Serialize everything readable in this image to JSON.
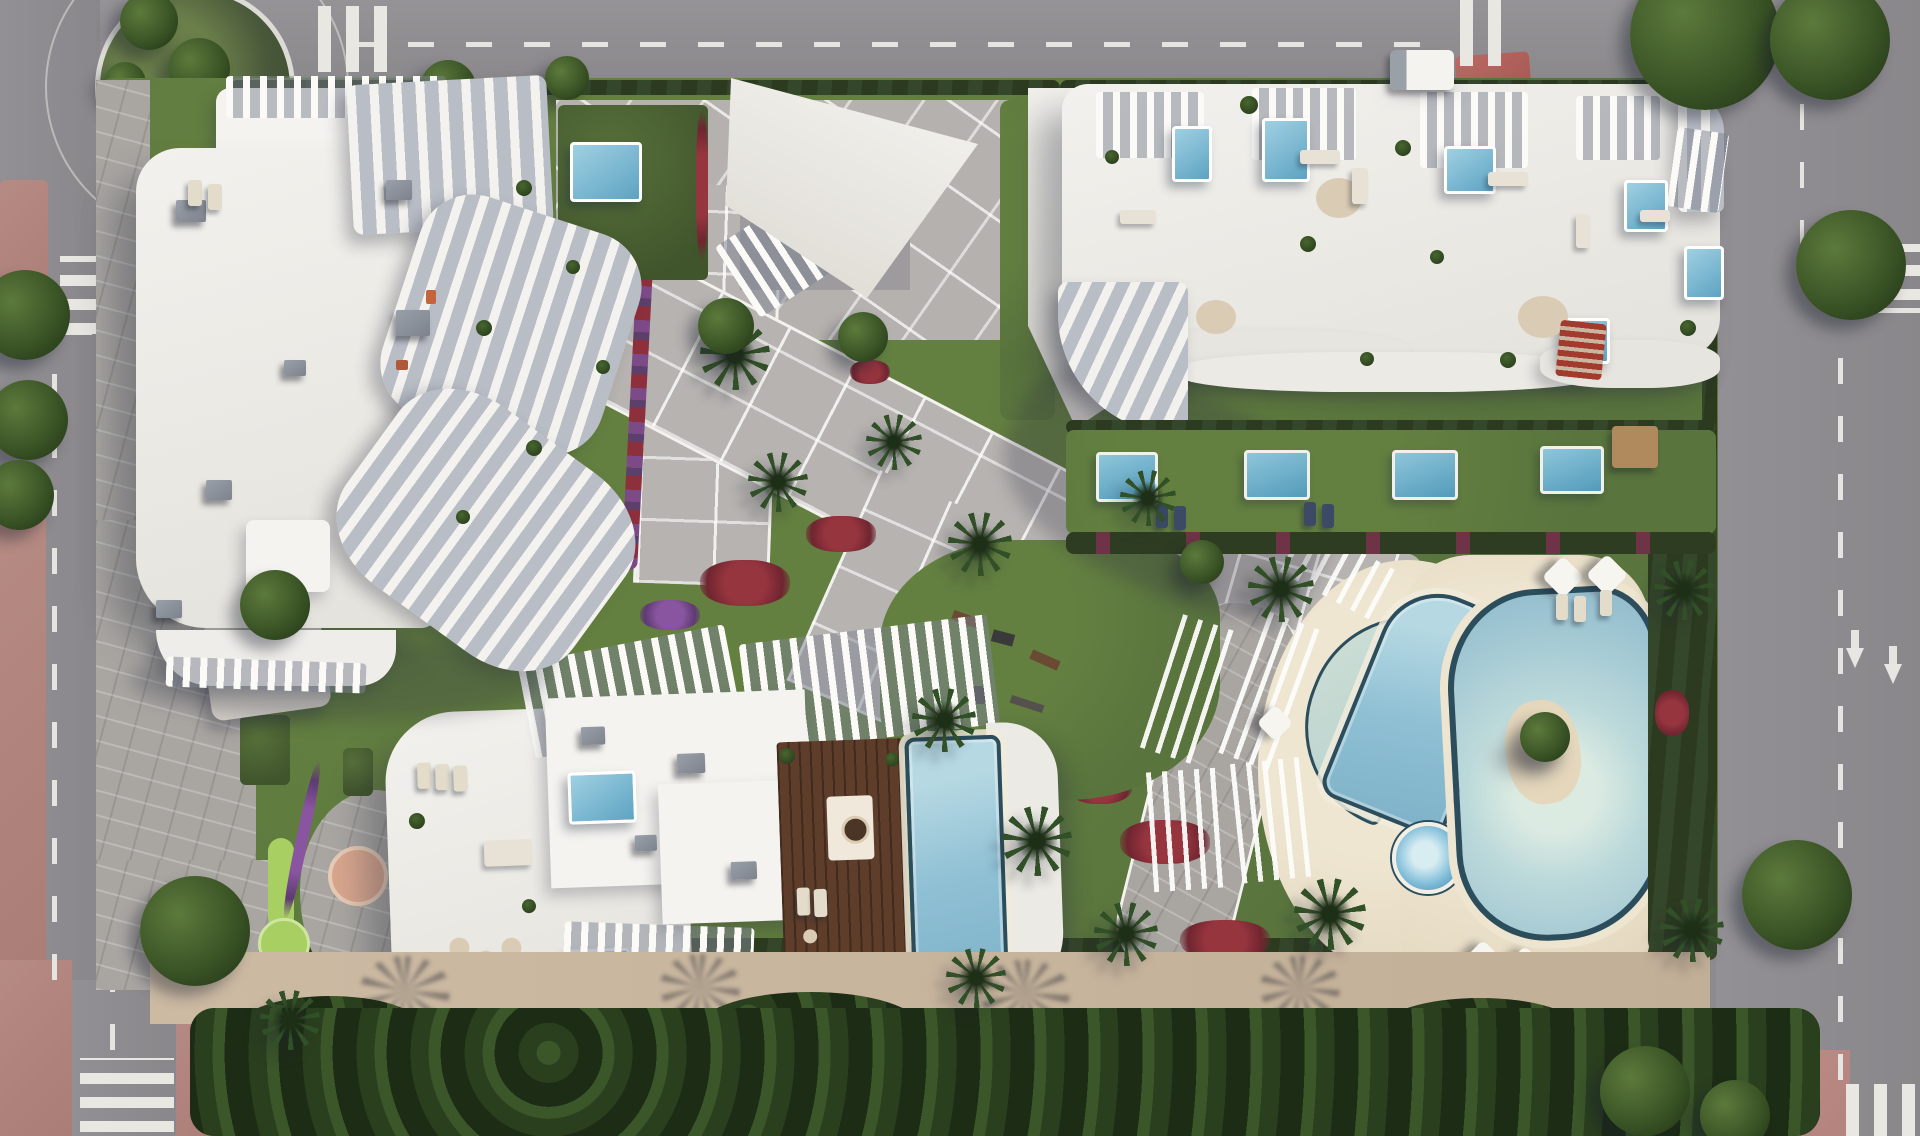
{
  "meta": {
    "title": "Aerial render of a seaside residential complex masterplan",
    "type": "architectural bird's-eye rendering",
    "canvas": "1920x1136"
  },
  "palette": {
    "asphalt": "#8f8d90",
    "road_marking_white": "#e8e6e2",
    "sidewalk_pink": "#b5837d",
    "plaza_pink": "#c08a84",
    "paver_gray": "#b6b3b0",
    "stone_path": "#a9a6a2",
    "lawn_green": "#59743d",
    "hedge_dark": "#2c3b20",
    "tree_green": "#3b5526",
    "putting_green": "#a8cf62",
    "peach_patio": "#d9a68e",
    "building_white": "#f2f1ed",
    "terrace_shade": "#b9bdc6",
    "sand_deck": "#e9dfc7",
    "wood_deck": "#5e3e2b",
    "pool_rim_dark": "#2c4d5c",
    "pool_water_light": "#bcd9da",
    "pool_water_deep": "#7fb2c8",
    "flower_red": "#8e2f3c",
    "flower_magenta": "#7b4a8e"
  },
  "scene": {
    "regions": [
      {
        "name": "ring-roads",
        "desc": "Asphalt streets with dashed lane lines, zebra crossings, arrows and a landscaped roundabout wrap the block on all four sides"
      },
      {
        "name": "roundabout",
        "desc": "Top-left roundabout with planted green island"
      },
      {
        "name": "building-a",
        "desc": "North-west apartment tower: white roof with AC units and curved white balcony ribs on its east facade"
      },
      {
        "name": "entrance-pavilions",
        "desc": "Top-centre white angular entrance canopies over a diagonally gridded plaza"
      },
      {
        "name": "building-b",
        "desc": "North-east slab building: rooftop terraces with plunge pools, pergolas and lounges; wavy balcony edge and private garden row below"
      },
      {
        "name": "promenade",
        "desc": "Wide diagonal paved promenade with white grid joints, palms and flower borders crossing the garden"
      },
      {
        "name": "central-garden",
        "desc": "Lawn with outdoor gym equipment, red and magenta flower drifts"
      },
      {
        "name": "building-c",
        "desc": "Southern building: rooftop terraces, two plunge pools, timber deck and a long infinity pool, framed by white pergola fins"
      },
      {
        "name": "pool-complex",
        "desc": "Sand-coloured deck with crescent reflection pool, diagonal lap pool, round kids pool and a large free-form lagoon pool with planted island"
      },
      {
        "name": "mini-golf-garden",
        "desc": "South-west garden with lime putting greens, gravel path and peach circular patio"
      },
      {
        "name": "south-edge",
        "desc": "Sand promenade, dense tree belt and pink pavement along the bottom street"
      }
    ]
  }
}
